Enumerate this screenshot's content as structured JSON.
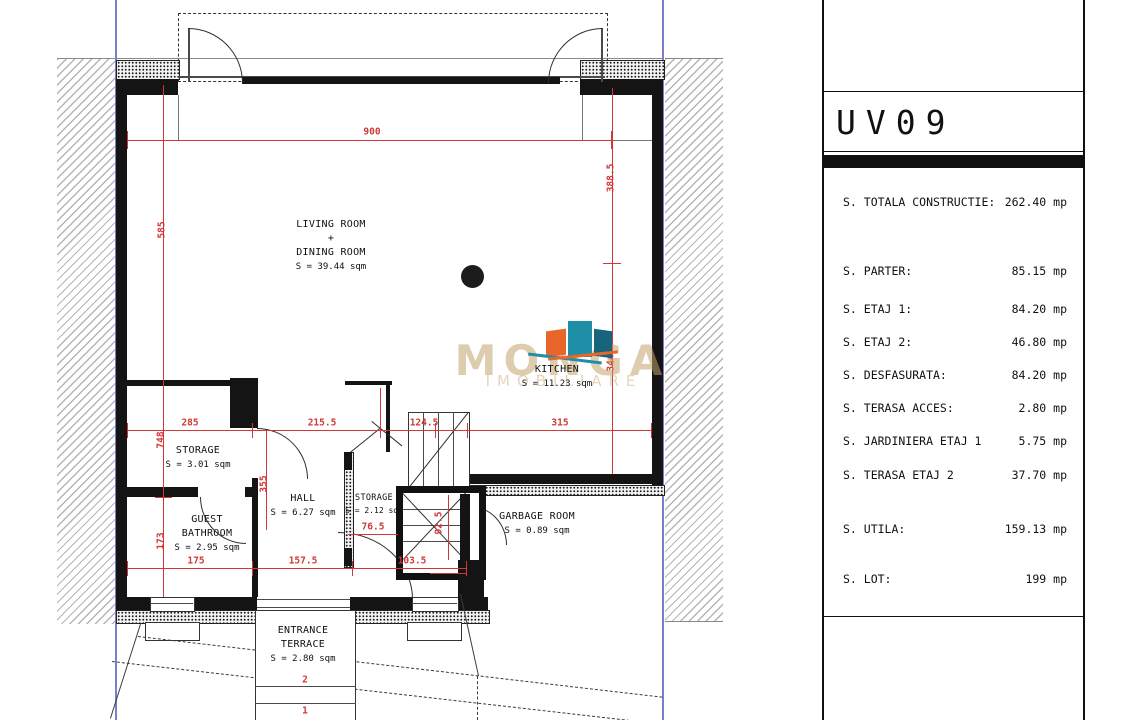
{
  "panel": {
    "title": "UV09",
    "rows": [
      {
        "label": "S. TOTALA CONSTRUCTIE:",
        "value": "262.40 mp"
      },
      {
        "label": "S. PARTER:",
        "value": "85.15 mp"
      },
      {
        "label": "S. ETAJ 1:",
        "value": "84.20 mp"
      },
      {
        "label": "S. ETAJ 2:",
        "value": "46.80 mp"
      },
      {
        "label": "S. DESFASURATA:",
        "value": "84.20 mp"
      },
      {
        "label": "S. TERASA ACCES:",
        "value": "2.80 mp"
      },
      {
        "label": "S. JARDINIERA ETAJ 1",
        "value": "5.75 mp"
      },
      {
        "label": "S. TERASA ETAJ 2",
        "value": "37.70 mp"
      },
      {
        "label": "S. UTILA:",
        "value": "159.13 mp"
      },
      {
        "label": "S. LOT:",
        "value": "199 mp"
      }
    ]
  },
  "plan": {
    "rooms": {
      "living": {
        "l1": "LIVING ROOM",
        "l2": "+",
        "l3": "DINING ROOM",
        "area": "S = 39.44 sqm"
      },
      "kitchen": {
        "l1": "KITCHEN",
        "area": "S = 11.23 sqm"
      },
      "storage1": {
        "l1": "STORAGE",
        "area": "S = 3.01 sqm"
      },
      "hall": {
        "l1": "HALL",
        "area": "S = 6.27 sqm"
      },
      "guest_bathroom": {
        "l1": "GUEST",
        "l2": "BATHROOM",
        "area": "S = 2.95 sqm"
      },
      "storage2": {
        "l1": "STORAGE",
        "area": "S = 2.12 sqm"
      },
      "garbage": {
        "l1": "GARBAGE ROOM",
        "area": "S = 0.89 sqm"
      },
      "terrace": {
        "l1": "ENTRANCE",
        "l2": "TERRACE",
        "area": "S = 2.80 sqm"
      }
    },
    "dims": {
      "d900": "900",
      "d585": "585",
      "d388_5": "388.5",
      "d344": "344",
      "d285": "285",
      "d215_5": "215.5",
      "d124_5": "124.5",
      "d315": "315",
      "d748": "748",
      "d355": "355",
      "d173": "173",
      "d175": "175",
      "d157_5": "157.5",
      "d103_5": "103.5",
      "d76_5": "76.5",
      "d92_5": "92.5",
      "step2": "2",
      "step1": "1"
    },
    "watermark": {
      "name": "MONGA",
      "sub": "IMOBILIARE"
    }
  },
  "colors": {
    "dimension_red": "#d23737",
    "boundary_blue": "#7b7ec9",
    "watermark_tan": "#c3a26e",
    "logo_orange": "#e8662a",
    "logo_teal": "#1f8fa8"
  }
}
